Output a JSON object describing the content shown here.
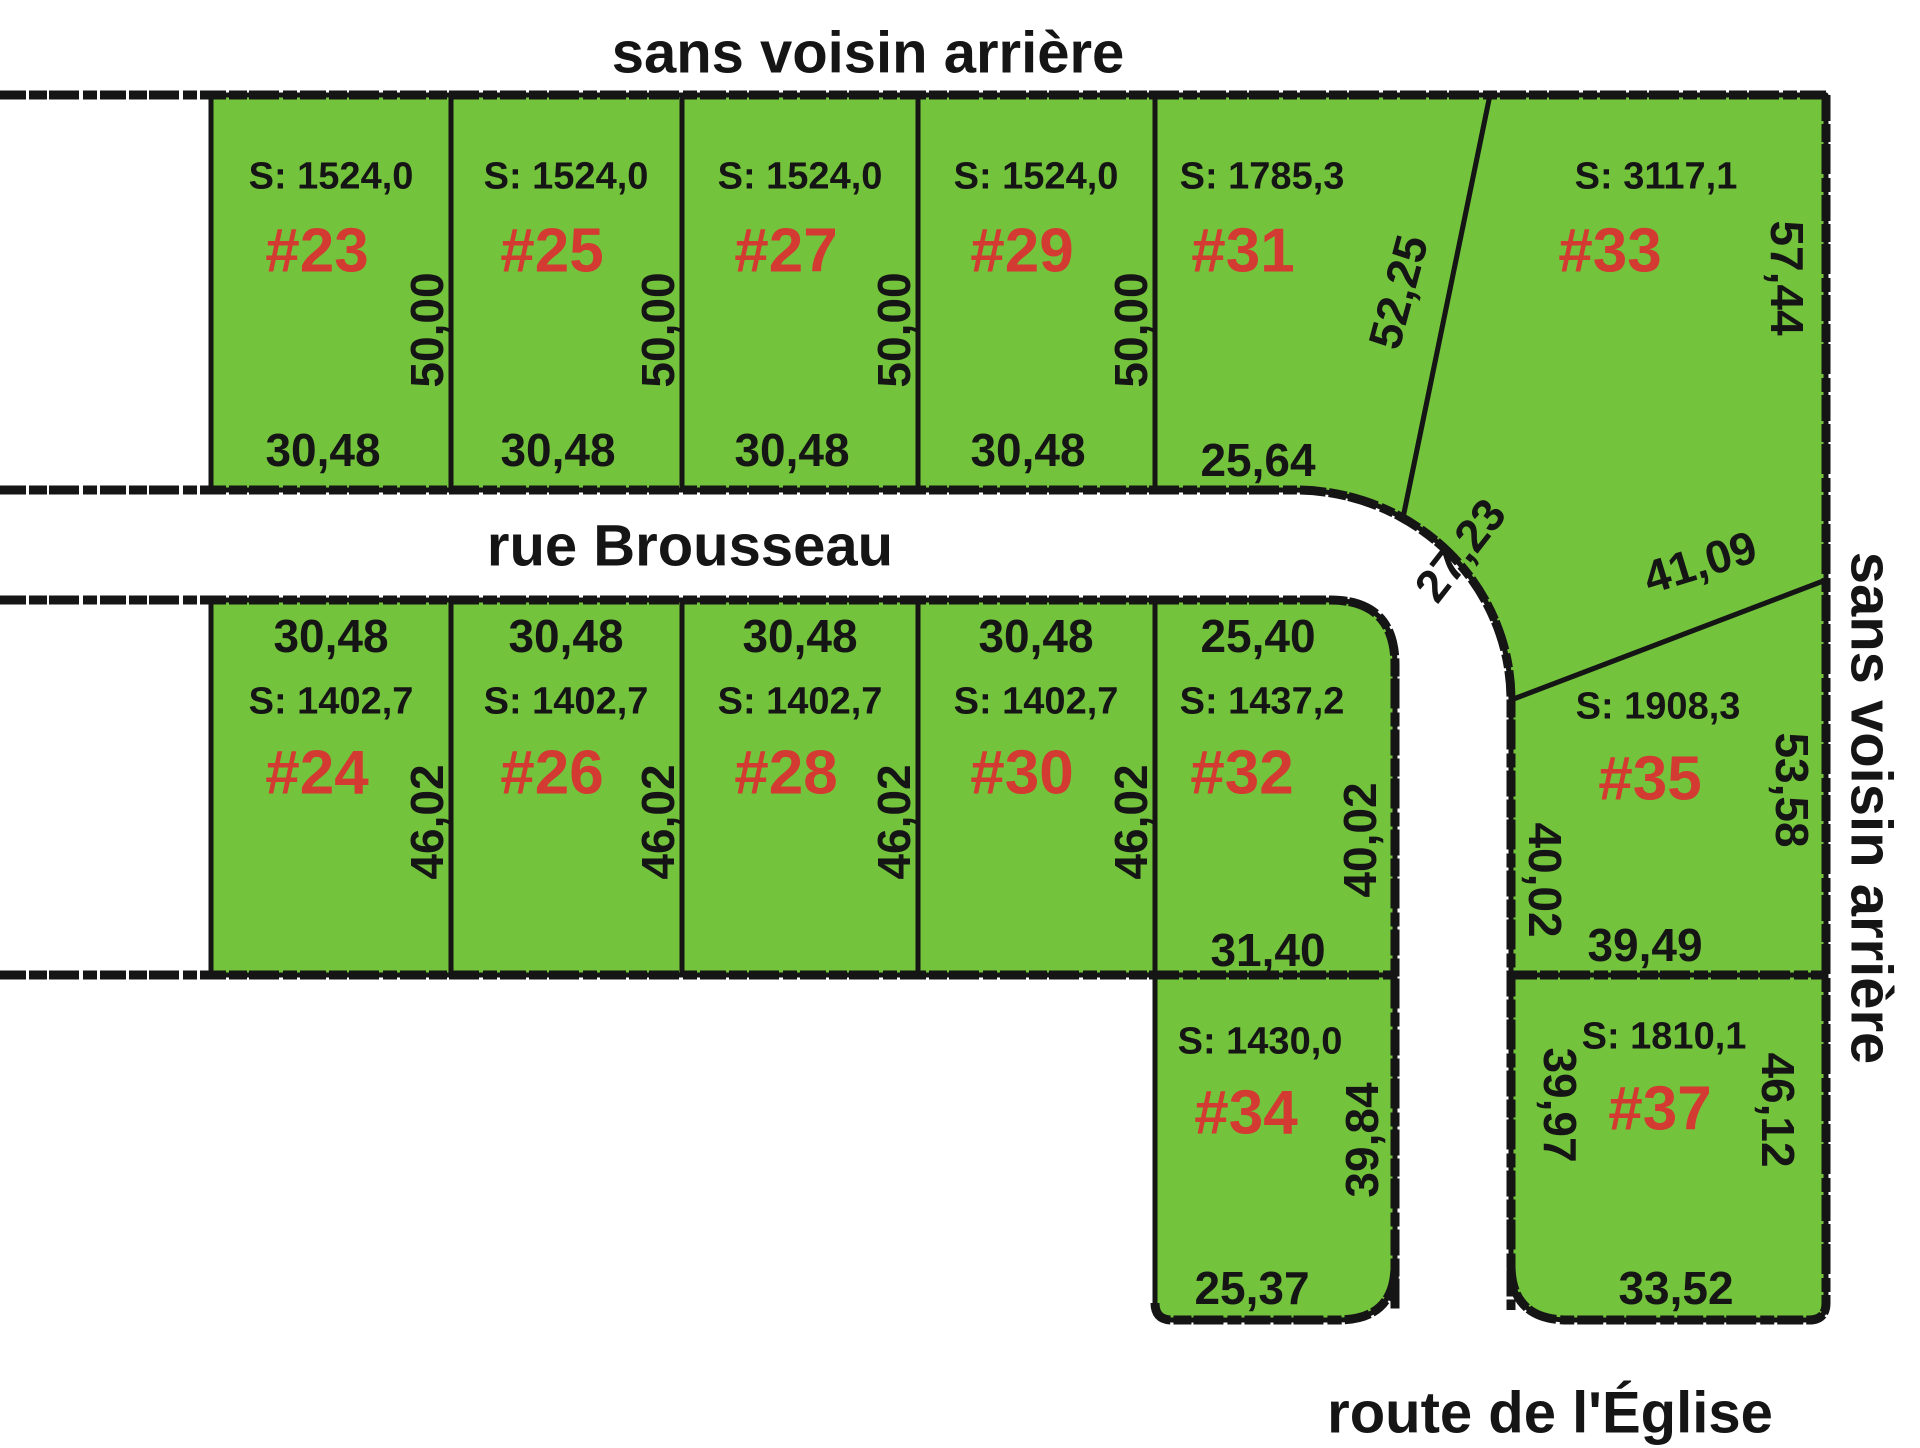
{
  "titles": {
    "top": "sans voisin arrière",
    "right": "sans voisin arrière",
    "street": "rue Brousseau",
    "bottom_road": "route de l'Église"
  },
  "colors": {
    "lot_fill": "#74c33c",
    "lot_number_red": "#d33a31",
    "line_black": "#151515"
  },
  "lots": [
    {
      "id": "23",
      "number": "#23",
      "area": "S: 1524,0",
      "depth": "50,00",
      "front": "30,48"
    },
    {
      "id": "25",
      "number": "#25",
      "area": "S: 1524,0",
      "depth": "50,00",
      "front": "30,48"
    },
    {
      "id": "27",
      "number": "#27",
      "area": "S: 1524,0",
      "depth": "50,00",
      "front": "30,48"
    },
    {
      "id": "29",
      "number": "#29",
      "area": "S: 1524,0",
      "depth": "50,00",
      "front": "30,48"
    },
    {
      "id": "31",
      "number": "#31",
      "area": "S: 1785,3",
      "front": "25,64",
      "side_diagonal": "52,25"
    },
    {
      "id": "33",
      "number": "#33",
      "area": "S: 3117,1",
      "side_right": "57,44",
      "corner_curve": "27,23",
      "side_diagonal": "41,09"
    },
    {
      "id": "24",
      "number": "#24",
      "area": "S: 1402,7",
      "front": "30,48",
      "depth": "46,02"
    },
    {
      "id": "26",
      "number": "#26",
      "area": "S: 1402,7",
      "front": "30,48",
      "depth": "46,02"
    },
    {
      "id": "28",
      "number": "#28",
      "area": "S: 1402,7",
      "front": "30,48",
      "depth": "46,02"
    },
    {
      "id": "30",
      "number": "#30",
      "area": "S: 1402,7",
      "front": "30,48",
      "depth": "46,02"
    },
    {
      "id": "32",
      "number": "#32",
      "area": "S: 1437,2",
      "front": "25,40",
      "depth": "40,02",
      "rear": "31,40"
    },
    {
      "id": "35",
      "number": "#35",
      "area": "S: 1908,3",
      "side_left": "40,02",
      "side_right": "53,58",
      "rear": "39,49"
    },
    {
      "id": "34",
      "number": "#34",
      "area": "S: 1430,0",
      "depth": "39,84",
      "rear": "25,37"
    },
    {
      "id": "37",
      "number": "#37",
      "area": "S: 1810,1",
      "side_left": "39,97",
      "side_right": "46,12",
      "rear": "33,52"
    }
  ]
}
